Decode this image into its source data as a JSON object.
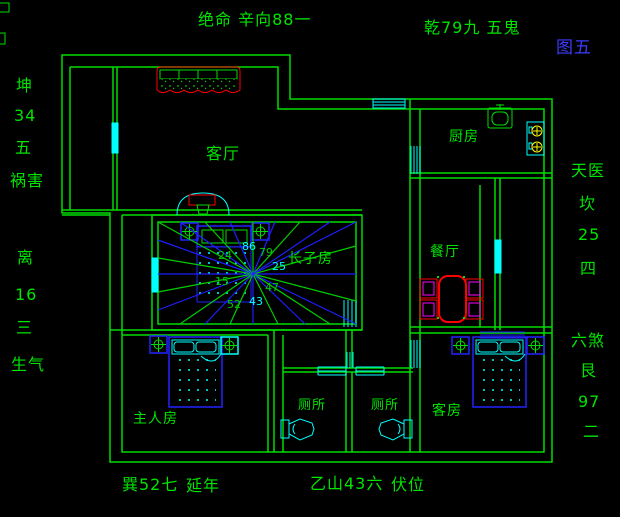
{
  "figure_label": "图五",
  "perimeter_labels": {
    "top_left": "绝命 辛向88一",
    "top_right": "乾79九 五鬼",
    "left_upper": [
      "坤",
      "34",
      "五",
      "祸害"
    ],
    "left_lower": [
      "离",
      "16",
      "三",
      "生气"
    ],
    "right_upper": [
      "天医",
      "坎",
      "25",
      "四"
    ],
    "right_lower": [
      "六煞",
      "艮",
      "97",
      "二"
    ],
    "bottom_left": [
      "巽52七",
      "延年"
    ],
    "bottom_right": [
      "乙山43六",
      "伏位"
    ]
  },
  "rooms": {
    "living_room": "客厅",
    "kitchen": "厨房",
    "dining_room": "餐厅",
    "eldest_son_room": "长子房",
    "master_bedroom": "主人房",
    "toilet_left": "厕所",
    "toilet_right": "厕所",
    "guest_room": "客房"
  },
  "compass_numbers": [
    {
      "value": "86",
      "color": "#00ffff"
    },
    {
      "value": "79",
      "color": "#00cc00"
    },
    {
      "value": "25",
      "color": "#00ffff"
    },
    {
      "value": "47",
      "color": "#00cc00"
    },
    {
      "value": "43",
      "color": "#00ffff"
    },
    {
      "value": "52",
      "color": "#00cc00"
    },
    {
      "value": "24",
      "color": "#00cc00"
    },
    {
      "value": "15",
      "color": "#00cc00"
    }
  ],
  "colors": {
    "background": "#000000",
    "walls_green": "#00dd00",
    "text_green": "#00e400",
    "figure_label_blue": "#3c3cff",
    "furniture_blue": "#2222ff",
    "fixture_cyan": "#00ffff",
    "accent_red": "#ff0000",
    "accent_magenta": "#ff00ff",
    "burner_yellow": "#ffff00"
  }
}
